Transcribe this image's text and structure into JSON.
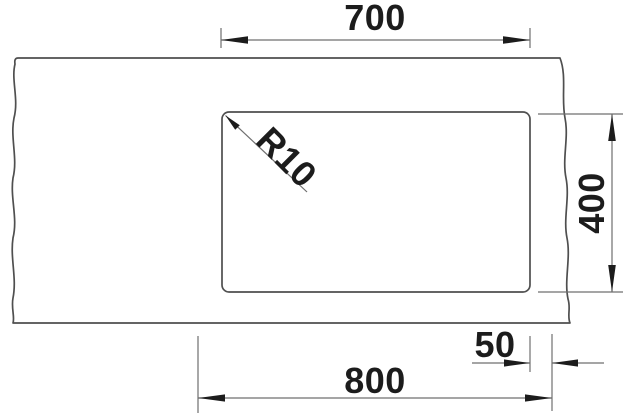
{
  "drawing": {
    "description": "technical-cutout-dimension-drawing",
    "colors": {
      "background": "#ffffff",
      "outline": "#4f4f4f",
      "dimension_lines": "#6f6f6f",
      "text_and_arrows": "#1c1c1c"
    },
    "dimensions": {
      "cutout_width": "700",
      "cutout_depth": "400",
      "cabinet_width": "800",
      "side_clearance": "50",
      "corner_radius": "R10"
    }
  }
}
